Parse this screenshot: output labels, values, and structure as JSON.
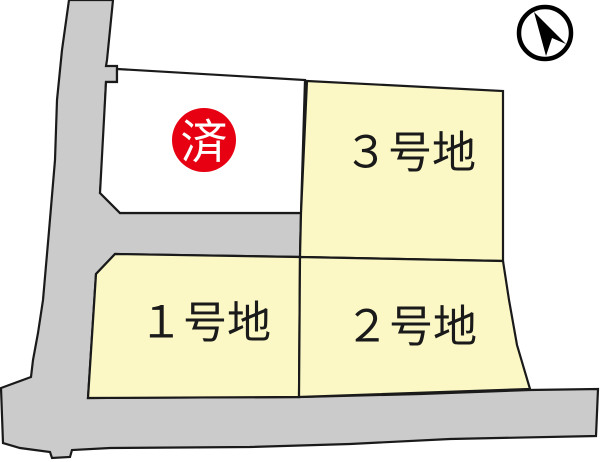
{
  "colors": {
    "background": "#ffffff",
    "road_fill": "#cbcbcb",
    "lot_available_fill": "#fbf8c5",
    "lot_sold_fill": "#ffffff",
    "outline": "#1a1a1a",
    "label_color": "#1a1a1a",
    "sold_badge_fill": "#e60012",
    "sold_badge_text_color": "#ffffff",
    "compass_color": "#000000"
  },
  "lots": [
    {
      "id": "lot-1",
      "label": "１号地",
      "status": "available"
    },
    {
      "id": "lot-2",
      "label": "２号地",
      "status": "available"
    },
    {
      "id": "lot-3",
      "label": "３号地",
      "status": "available"
    }
  ],
  "sold_lot": {
    "badge_text": "済"
  }
}
